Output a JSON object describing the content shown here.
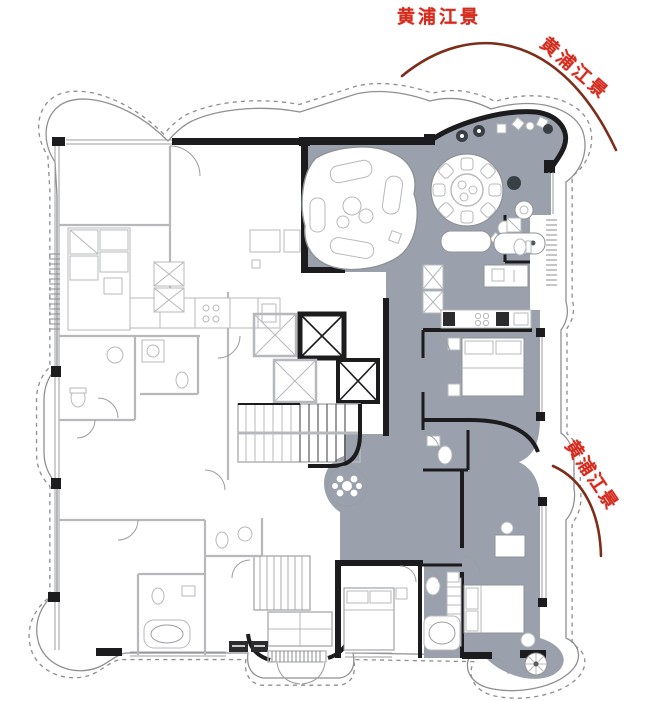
{
  "annotations": {
    "river_view_top": "黄浦江景",
    "river_view_top_right": "黄浦江景",
    "river_view_right": "黄浦江景"
  },
  "colors": {
    "label_red": "#d92a1b",
    "arc_maroon": "#7d2e1b",
    "unit_fill": "#9aa1ac",
    "wall_dark": "#1c1c1e",
    "wall_light": "#b6b8bb",
    "background": "#ffffff"
  }
}
